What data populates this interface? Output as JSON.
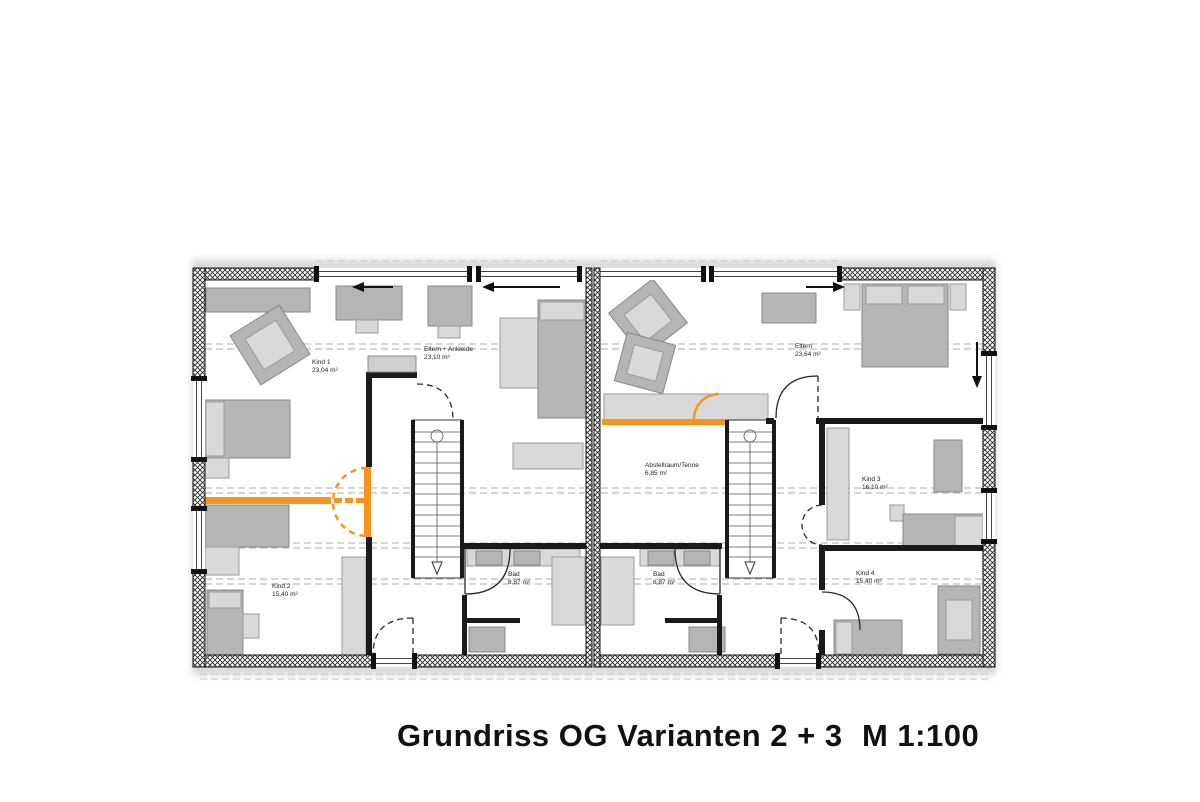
{
  "title": {
    "main": "Grundriss OG Varianten 2 + 3",
    "scale": "M 1:100"
  },
  "colors": {
    "highlight": "#f7941d",
    "wall": "#1a1a1a",
    "furniture": "#b5b5b5",
    "furniture_light": "#d9d9d9",
    "refline": "#bdbdbd"
  },
  "rooms": {
    "kind1": {
      "name": "Kind 1",
      "area": "23,04 m²"
    },
    "eltern_ankleide": {
      "name": "Eltern + Ankleide",
      "area": "23,10 m²"
    },
    "kind2": {
      "name": "Kind 2",
      "area": "15,40 m²"
    },
    "bad_links": {
      "name": "Bad",
      "area": "8,87 m²"
    },
    "abstellraum": {
      "name": "Abstellraum/Tenne",
      "area": "6,85 m²"
    },
    "eltern": {
      "name": "Eltern",
      "area": "23,64 m²"
    },
    "bad_rechts": {
      "name": "Bad",
      "area": "8,87 m²"
    },
    "kind3": {
      "name": "Kind 3",
      "area": "16,10 m²"
    },
    "kind4": {
      "name": "Kind 4",
      "area": "15,40 m²"
    }
  }
}
